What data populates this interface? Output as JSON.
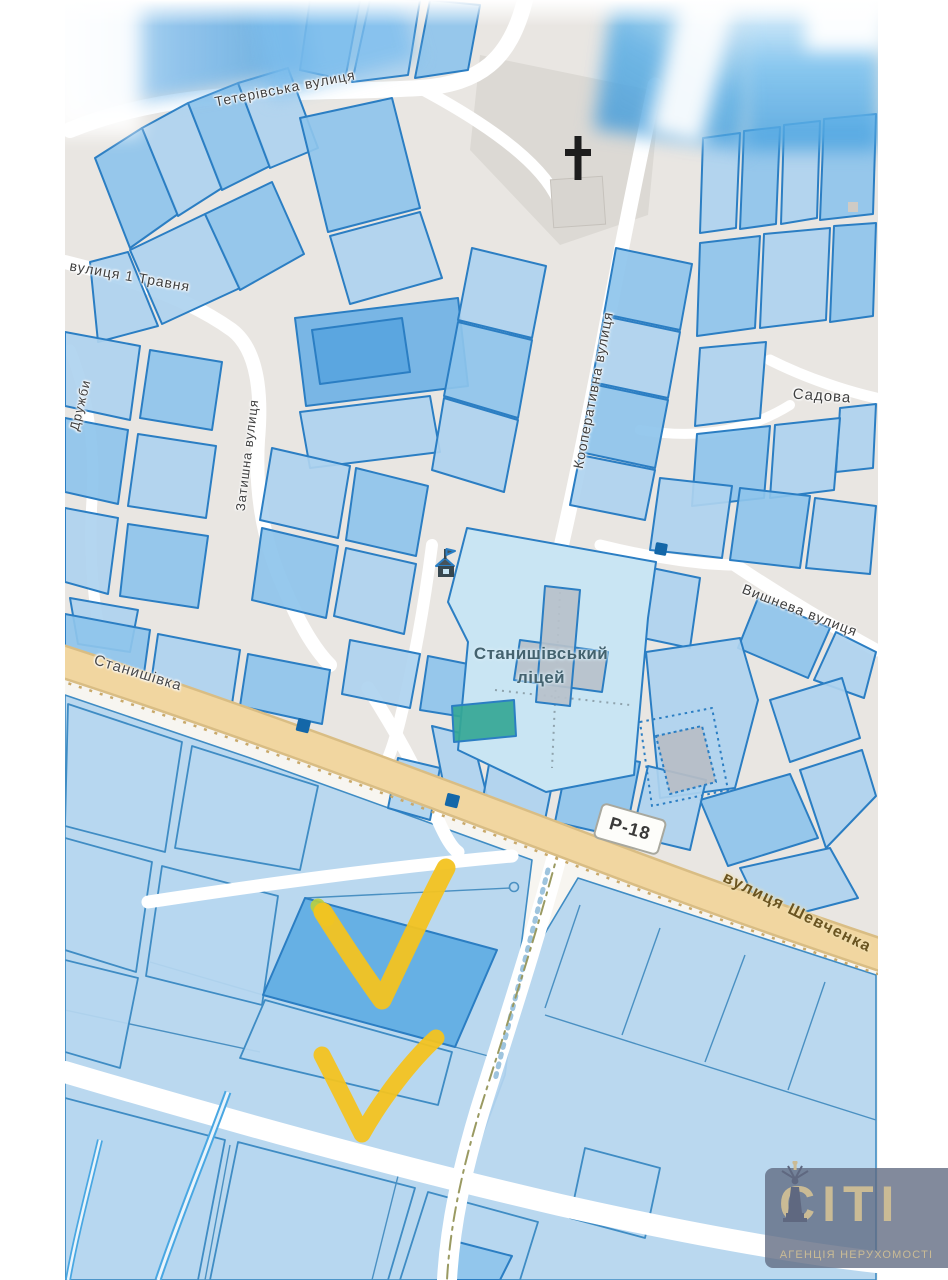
{
  "labels": {
    "teterivska": "Тетерівська вулиця",
    "travnya": "вулиця 1 Травня",
    "kooperatyvna": "Кооперативна вулиця",
    "zatyshna": "Затишна вулиця",
    "druzhby": "Дружби",
    "sadova": "Садова",
    "vyshneva": "Вишнева вулиця",
    "stanyshivka": "Станишівка",
    "shevchenka": "вулиця Шевченка",
    "road_ref": "Р-18",
    "lyceum_line1": "Станишівський",
    "lyceum_line2": "ліцей"
  },
  "watermark": {
    "logo": "CITI",
    "logo_first_letter": "C",
    "logo_rest": "ITI",
    "subtitle": "АГЕНЦІЯ НЕРУХОМОСТІ"
  },
  "colors": {
    "parcel_fill_light": "#aed3ef",
    "parcel_fill_medium": "#8ec4ec",
    "parcel_fill_strong": "#6fb2e5",
    "parcel_stroke": "#2b7ec3",
    "lower_parcel_fill": "#b4d5ef",
    "highlight_fill": "#66b0e4",
    "highlight_border": "#78203d",
    "checkmark_yellow": "#f3c320",
    "road_primary_fill": "#f1d6a0",
    "map_bg_upper": "#e9e6e2",
    "map_bg_lower": "#f7f5f0",
    "lyceum_fill": "#c9e5f3",
    "sports_field_green": "#35a796",
    "marker_blue": "#1467a8",
    "watermark_bg": "rgba(95,105,128,0.78)",
    "watermark_text": "#cabb95"
  }
}
